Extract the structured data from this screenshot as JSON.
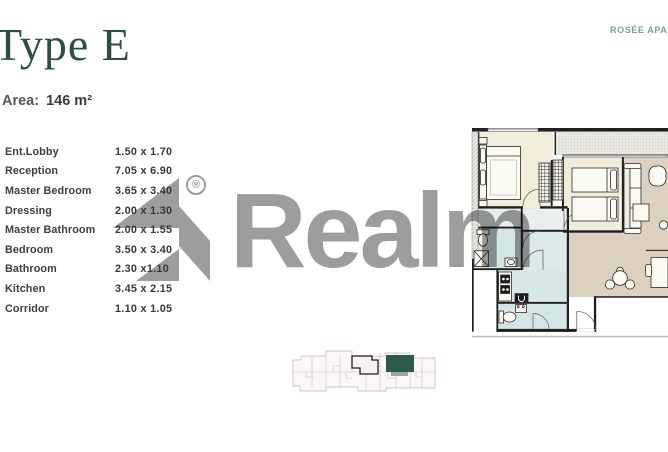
{
  "header": {
    "title": "Type E",
    "area_label": "Area:",
    "area_value": "146 m²",
    "project_label": "ROSÉE APA"
  },
  "rooms": [
    {
      "name": "Ent.Lobby",
      "dims": "1.50 x 1.70"
    },
    {
      "name": "Reception",
      "dims": "7.05 x 6.90"
    },
    {
      "name": "Master Bedroom",
      "dims": "3.65 x 3.40"
    },
    {
      "name": "Dressing",
      "dims": "2.00 x 1.30"
    },
    {
      "name": "Master Bathroom",
      "dims": "2.00 x 1.55"
    },
    {
      "name": "Bedroom",
      "dims": "3.50 x 3.40"
    },
    {
      "name": "Bathroom",
      "dims": "2.30 x1.10"
    },
    {
      "name": "Kitchen",
      "dims": "3.45 x 2.15"
    },
    {
      "name": "Corridor",
      "dims": "1.10 x 1.05"
    }
  ],
  "watermark": {
    "brand": "Realm",
    "registered": "®",
    "color": "#9d9d9d"
  },
  "floor_plan": {
    "wall_color": "#202020",
    "bedroom_fill": "#f1edda",
    "living_fill": "#dcd1c1",
    "wet_area_fill": "#d4e5e6",
    "balcony_fill": "#ecebe3"
  },
  "key_plan": {
    "outline_color": "#c9b3b3",
    "selected_unit_color": "#2e5a4c"
  }
}
